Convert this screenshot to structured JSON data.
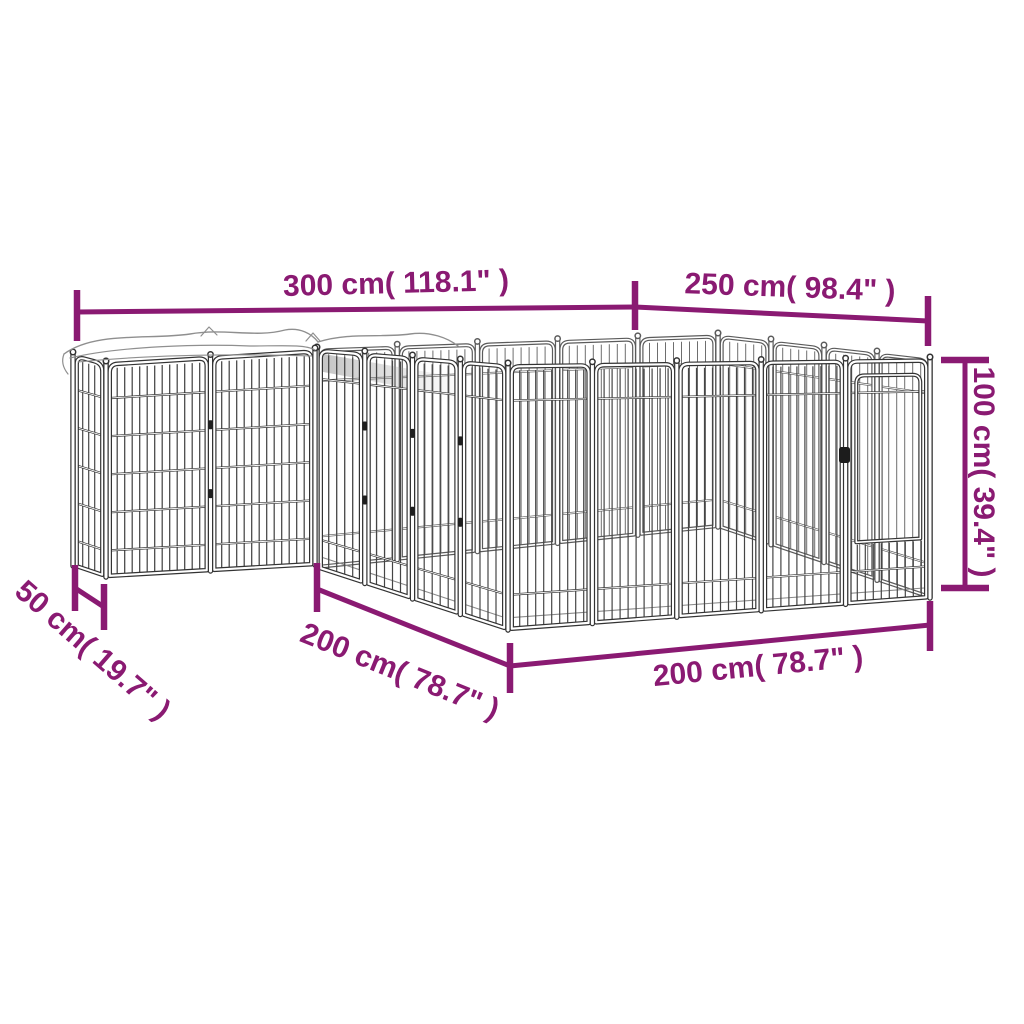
{
  "figure": {
    "subject": "metal dog playpen wireframe with covered annex",
    "style": "isometric line drawing"
  },
  "colors": {
    "dimension": "#8a1a72",
    "frame_dark": "#333333",
    "frame_back": "#5b5b5b",
    "bar_dark": "#454545",
    "bar_back": "#6e6e6e",
    "cover_line": "#8f8f8f",
    "fabric_shade": "#9c9c9c",
    "latch": "#1c1c1c",
    "background": "#ffffff"
  },
  "dimensions": {
    "top_left": {
      "label": "300 cm( 118.1\" )",
      "value_cm": 300,
      "value_in": "118.1"
    },
    "top_right": {
      "label": "250 cm( 98.4\" )",
      "value_cm": 250,
      "value_in": "98.4"
    },
    "height": {
      "label": "100 cm( 39.4\" )",
      "value_cm": 100,
      "value_in": "39.4"
    },
    "annex_depth": {
      "label": "50 cm( 19.7\" )",
      "value_cm": 50,
      "value_in": "19.7"
    },
    "side_left": {
      "label": "200 cm( 78.7\" )",
      "value_cm": 200,
      "value_in": "78.7"
    },
    "side_front": {
      "label": "200 cm( 78.7\" )",
      "value_cm": 200,
      "value_in": "78.7"
    }
  }
}
